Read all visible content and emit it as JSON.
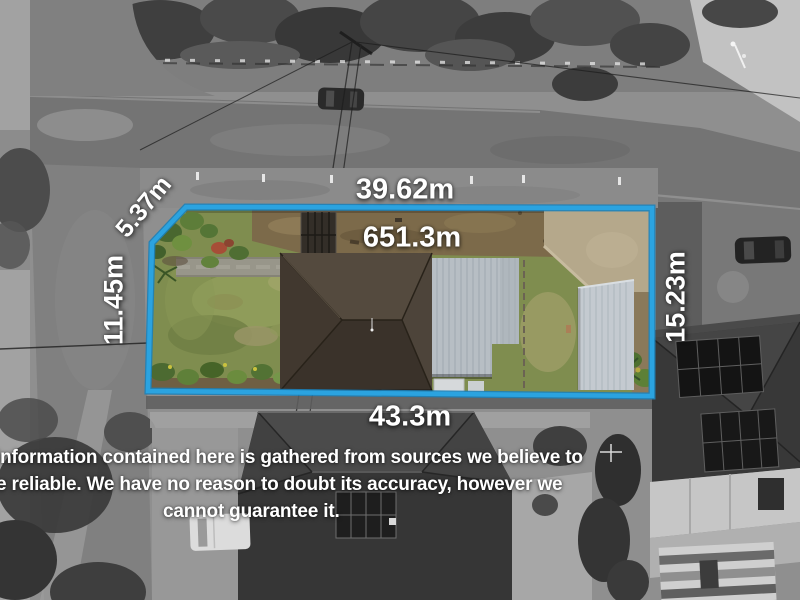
{
  "measurements": {
    "top": "39.62m",
    "top_left_diagonal": "5.37m",
    "left": "11.45m",
    "right": "15.23m",
    "bottom": "43.3m",
    "area": "651.3m"
  },
  "disclaimer": {
    "line1": "information contained here is gathered from sources we believe to",
    "line2": "e reliable. We have no reason to doubt its accuracy, however we",
    "line3": "cannot guarantee it."
  },
  "colors": {
    "boundary_blue": "#2ba3e0",
    "label_text": "#ffffff"
  }
}
